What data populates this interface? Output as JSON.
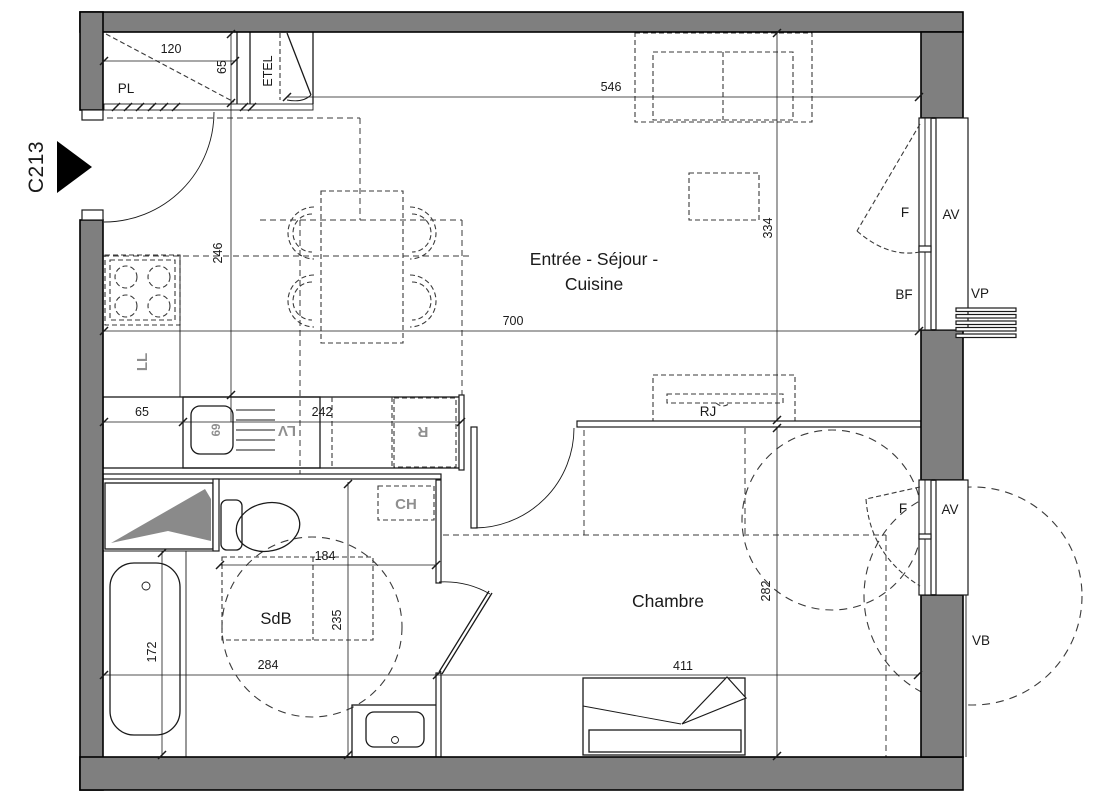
{
  "plan": {
    "unit": "C213",
    "rooms": {
      "living_line1": "Entrée - Séjour -",
      "living_line2": "Cuisine",
      "bedroom": "Chambre",
      "bathroom": "SdB"
    },
    "fixtures": {
      "closet": "PL",
      "technical": "ETEL",
      "washer": "LL",
      "dishwasher": "LV",
      "fridge": "R",
      "water_heater": "CH",
      "radiator": "RJ"
    },
    "openings": {
      "window_top": "F",
      "blind_top": "AV",
      "low_window": "BF",
      "shutter": "VP",
      "window_bottom": "F",
      "blind_bottom": "AV",
      "roller_blind": "VB"
    },
    "dims": {
      "pl_width": "120",
      "pl_depth": "65",
      "living_width": "546",
      "living_height": "334",
      "room_width": "700",
      "kitchen_depth": "246",
      "counter_left": "65",
      "counter_right": "242",
      "sink_width": "69",
      "bath_width": "184",
      "bath_depth": "235",
      "bath_floor": "284",
      "tub_length": "172",
      "bedroom_width": "411",
      "bedroom_height": "282"
    },
    "colors": {
      "wall": "#7f7f7f",
      "line": "#1a1a1a",
      "dashed": "#3a3a3a",
      "appliance": "#8f8f8f",
      "background": "#ffffff"
    }
  }
}
